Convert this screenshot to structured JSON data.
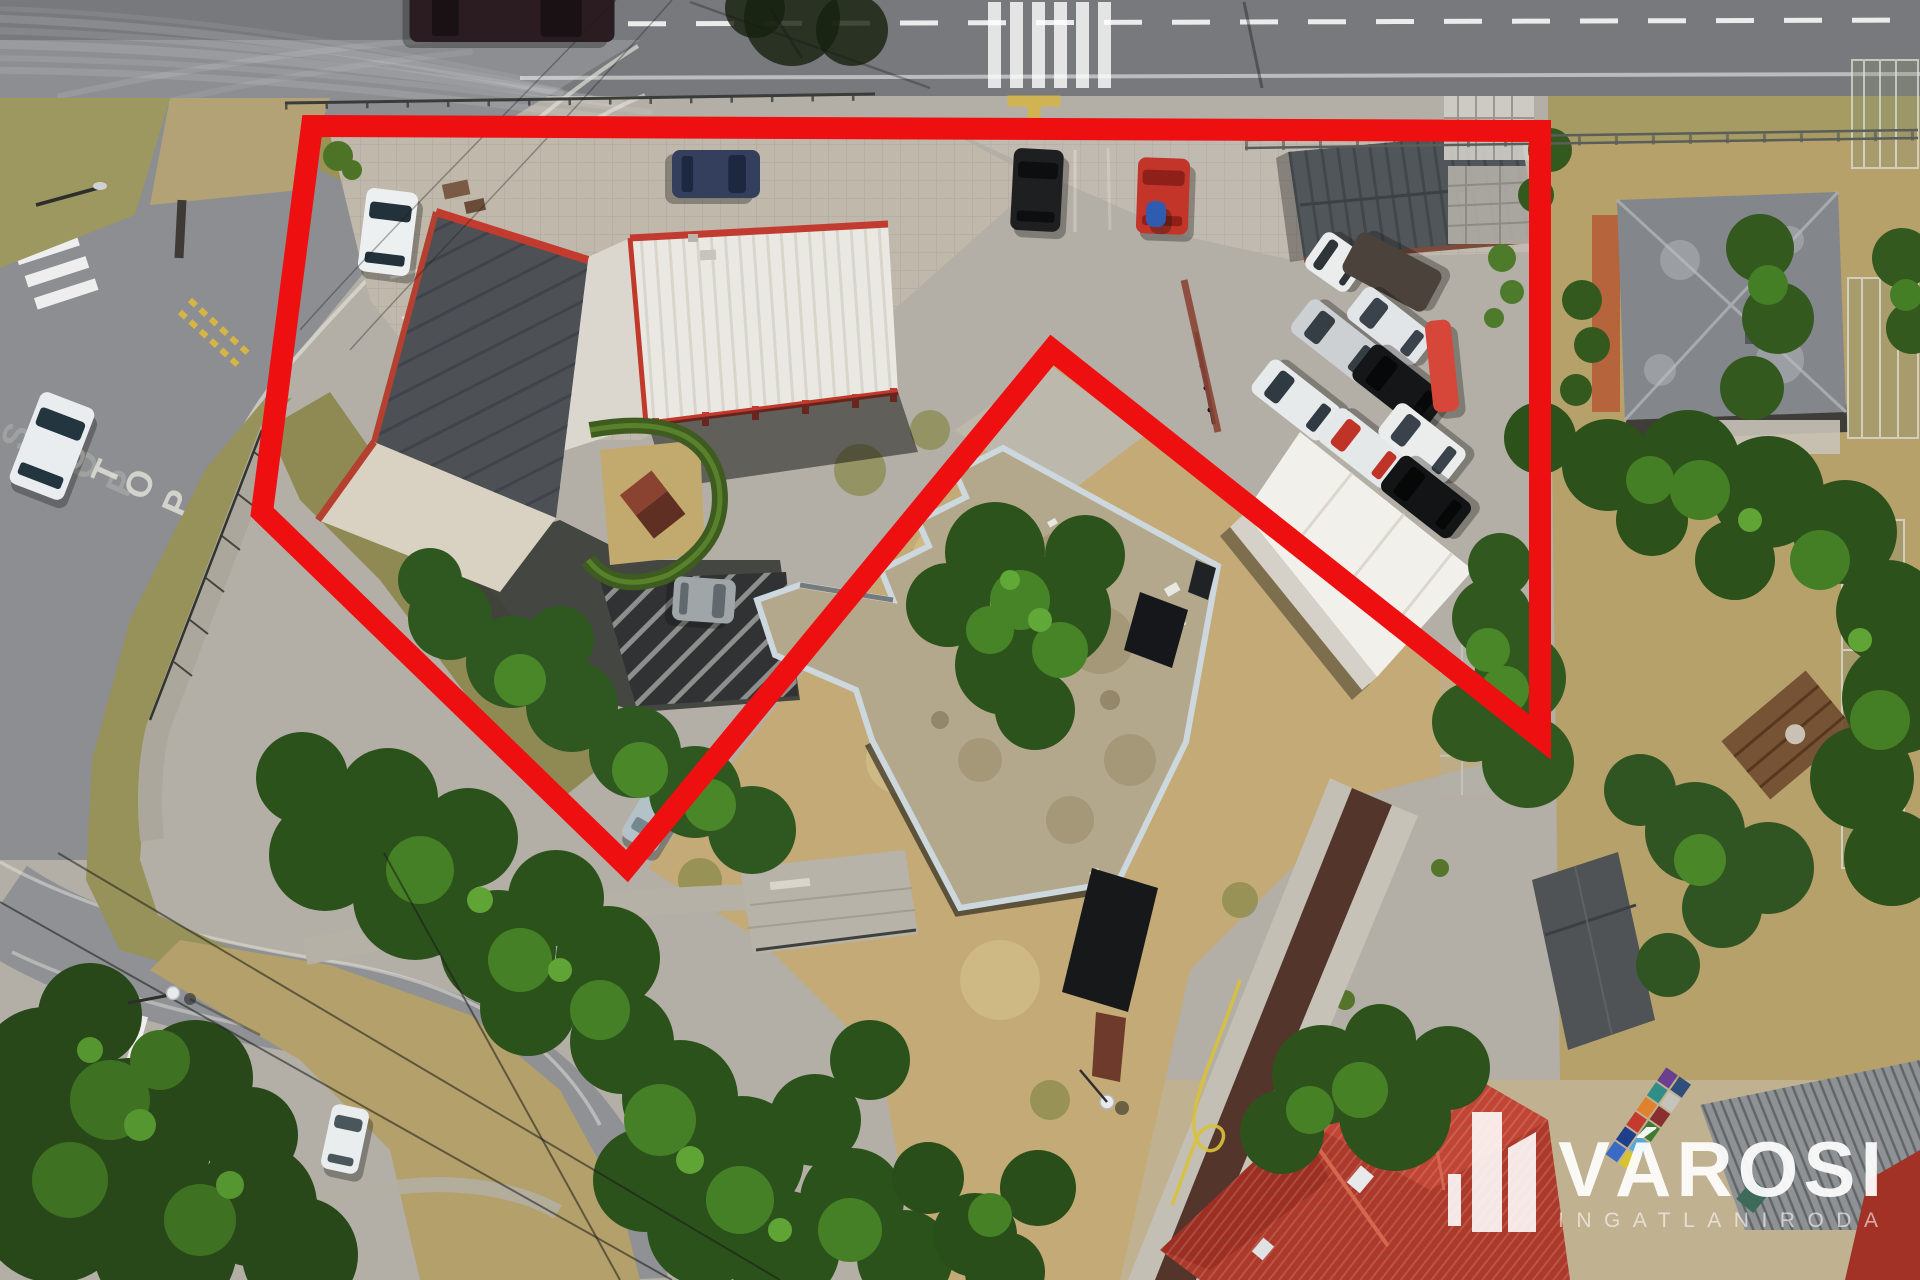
{
  "scene": {
    "type": "aerial-drone-photo",
    "description": "Bird's-eye drone photo of a commercial property and surroundings with a red boundary outline",
    "width": 1920,
    "height": 1280
  },
  "road_markings": {
    "stop_text": "STOP"
  },
  "watermark": {
    "title": "VÁROSI",
    "subtitle": "INGATLANIRODA",
    "color": "#ffffff"
  },
  "outline": {
    "color": "#ee1010",
    "stroke_width": 22,
    "points": [
      [
        312,
        126
      ],
      [
        1540,
        131
      ],
      [
        1540,
        737
      ],
      [
        1052,
        350
      ],
      [
        627,
        866
      ],
      [
        262,
        512
      ]
    ]
  },
  "palette": {
    "outline_red": "#ee1010",
    "asphalt": "#77797c",
    "pavement": "#b3afa6",
    "dry_grass": "#c3aa76",
    "tree_green": "#2c521c",
    "roof_white": "#eae8e2",
    "roof_dark": "#4d5156",
    "roof_tan": "#b4a88c",
    "roof_red_tile": "#ad392a"
  },
  "vehicles": [
    {
      "name": "car-dark-top-road",
      "cx": 512,
      "cy": 14,
      "wid": 56,
      "len": 205,
      "rot": 90,
      "body": "#2a1c20",
      "glass": "#1a1114"
    },
    {
      "name": "car-white-side-road",
      "cx": 52,
      "cy": 446,
      "wid": 58,
      "len": 98,
      "rot": 21,
      "body": "#e9edef",
      "glass": "#233640"
    },
    {
      "name": "van-navy-parking",
      "cx": 716,
      "cy": 174,
      "wid": 48,
      "len": 88,
      "rot": 90,
      "body": "#333f5c",
      "glass": "#1d2740"
    },
    {
      "name": "car-black-parking",
      "cx": 1037,
      "cy": 190,
      "wid": 50,
      "len": 82,
      "rot": 3,
      "body": "#1d1f21",
      "glass": "#0d0e10"
    },
    {
      "name": "truck-red-parking",
      "cx": 1163,
      "cy": 196,
      "wid": 52,
      "len": 76,
      "rot": 2,
      "body": "#c23528",
      "glass": "#8e2019"
    },
    {
      "name": "cargo-blue-box",
      "cx": 1156,
      "cy": 214,
      "wid": 20,
      "len": 26,
      "rot": 2,
      "body": "#2f5cb0",
      "glass": "#2f5cb0"
    },
    {
      "name": "car-grey-hatch",
      "cx": 704,
      "cy": 600,
      "wid": 44,
      "len": 62,
      "rot": 94,
      "body": "#a0a5a8",
      "glass": "#62696e"
    },
    {
      "name": "car-white-lot",
      "cx": 388,
      "cy": 232,
      "wid": 52,
      "len": 84,
      "rot": 7,
      "body": "#edf0f1",
      "glass": "#22313a"
    },
    {
      "name": "car-white-grass",
      "cx": 345,
      "cy": 1139,
      "wid": 38,
      "len": 66,
      "rot": 12,
      "body": "#e9edee",
      "glass": "#49565c"
    },
    {
      "name": "van-white-flatbed",
      "cx": 1336,
      "cy": 262,
      "wid": 44,
      "len": 52,
      "rot": -55,
      "body": "#eaedec",
      "glass": "#2e3539"
    },
    {
      "name": "trailer-flatbed",
      "cx": 1392,
      "cy": 272,
      "wid": 46,
      "len": 94,
      "rot": -62,
      "body": "#4a423b",
      "glass": "#4a423b"
    },
    {
      "name": "car-silver-a",
      "cx": 1337,
      "cy": 341,
      "wid": 42,
      "len": 92,
      "rot": -52,
      "body": "#ccd0d3",
      "glass": "#363e45"
    },
    {
      "name": "car-silver-b",
      "cx": 1390,
      "cy": 326,
      "wid": 40,
      "len": 86,
      "rot": -52,
      "body": "#e2e5e7",
      "glass": "#3a434b"
    },
    {
      "name": "suv-black",
      "cx": 1399,
      "cy": 387,
      "wid": 44,
      "len": 92,
      "rot": -52,
      "body": "#141618",
      "glass": "#070809"
    },
    {
      "name": "car-white-a",
      "cx": 1296,
      "cy": 400,
      "wid": 42,
      "len": 88,
      "rot": -52,
      "body": "#e7eaeb",
      "glass": "#303a42"
    },
    {
      "name": "car-white-red-roof",
      "cx": 1362,
      "cy": 448,
      "wid": 42,
      "len": 86,
      "rot": -52,
      "body": "#e5e8e9",
      "glass": "#c03428"
    },
    {
      "name": "car-white-b",
      "cx": 1422,
      "cy": 443,
      "wid": 42,
      "len": 86,
      "rot": -52,
      "body": "#ebeded",
      "glass": "#3a434b"
    },
    {
      "name": "car-black-b",
      "cx": 1426,
      "cy": 497,
      "wid": 44,
      "len": 88,
      "rot": -52,
      "body": "#121416",
      "glass": "#060707"
    },
    {
      "name": "trailer-red-white",
      "cx": 1442,
      "cy": 366,
      "wid": 26,
      "len": 92,
      "rot": -6,
      "body": "#d64639",
      "glass": "#d64639"
    },
    {
      "name": "car-pale-under-trees",
      "cx": 663,
      "cy": 800,
      "wid": 40,
      "len": 104,
      "rot": 31,
      "body": "#b3c2c9",
      "glass": "#75878f"
    }
  ]
}
